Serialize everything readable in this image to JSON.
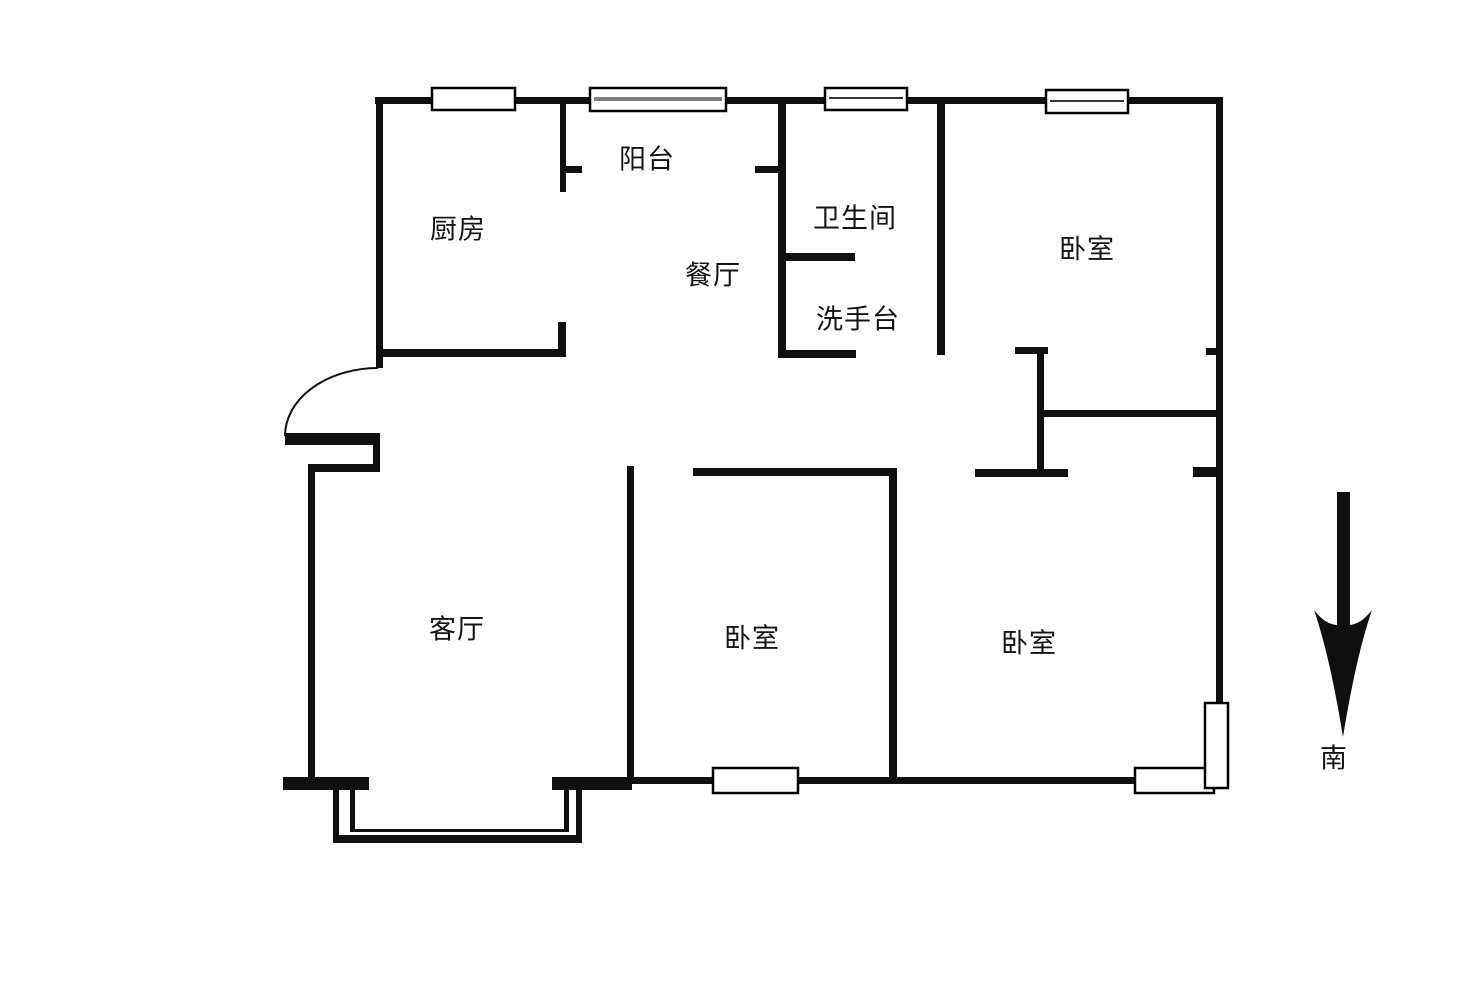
{
  "floor_plan": {
    "type": "apartment-floor-plan",
    "rooms": [
      {
        "id": "kitchen",
        "label": "厨房"
      },
      {
        "id": "balcony",
        "label": "阳台"
      },
      {
        "id": "dining",
        "label": "餐厅"
      },
      {
        "id": "bathroom",
        "label": "卫生间"
      },
      {
        "id": "washstand",
        "label": "洗手台"
      },
      {
        "id": "bedroom-north",
        "label": "卧室"
      },
      {
        "id": "living-room",
        "label": "客厅"
      },
      {
        "id": "bedroom-south-middle",
        "label": "卧室"
      },
      {
        "id": "bedroom-south-east",
        "label": "卧室"
      }
    ],
    "compass": {
      "icon": "arrow-down-icon",
      "direction_label": "南"
    },
    "colors": {
      "background": "#ffffff",
      "wall": "#0f0f0f",
      "window_fill": "#ffffff",
      "window_border": "#000000",
      "glass_line_gray": "#7d7d7d",
      "glass_line_dark": "#333333",
      "text": "#141414"
    }
  }
}
